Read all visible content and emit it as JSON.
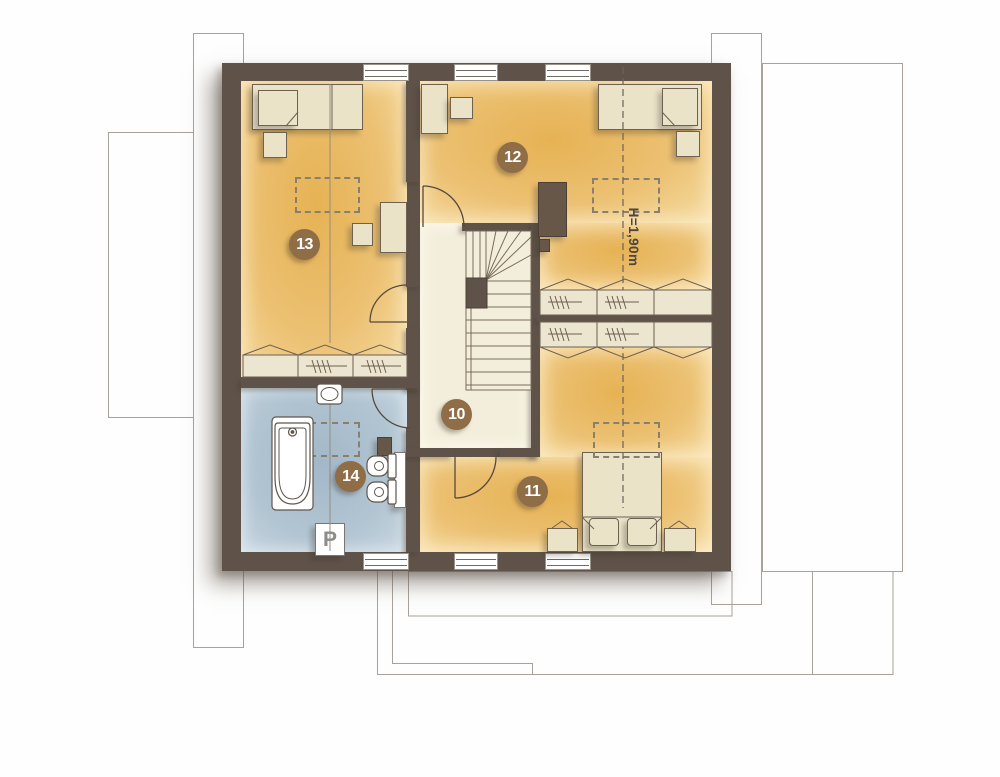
{
  "floorplan": {
    "room_badges": [
      {
        "id": "badge-10",
        "label": "10"
      },
      {
        "id": "badge-11",
        "label": "11"
      },
      {
        "id": "badge-12",
        "label": "12"
      },
      {
        "id": "badge-13",
        "label": "13"
      },
      {
        "id": "badge-14",
        "label": "14"
      }
    ],
    "annotations": {
      "attic_height": "H=1,90m",
      "washing_machine": "P"
    },
    "colors": {
      "wall": "#5f5349",
      "room_floor": "#ecc173",
      "hall_floor": "#f3eedb",
      "bath_floor": "#b2c5d2",
      "badge": "#8f6d47",
      "outline": "#a8a29a"
    }
  }
}
